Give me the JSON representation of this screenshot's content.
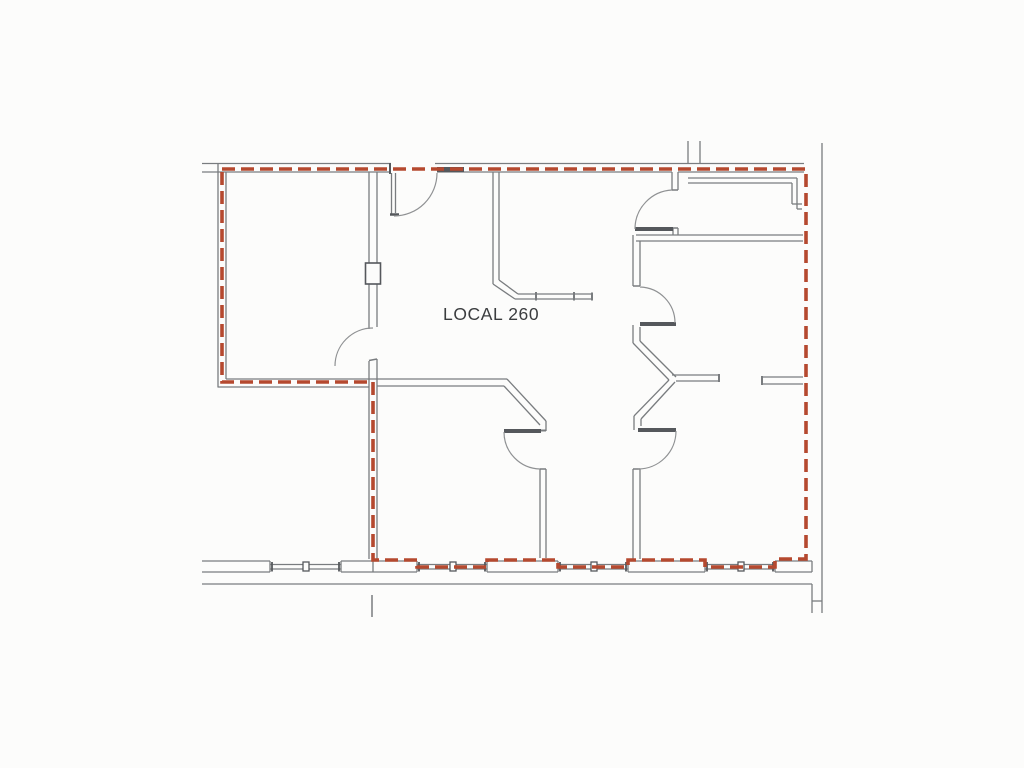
{
  "page": {
    "background": "#fcfcfb"
  },
  "plan": {
    "label": {
      "text": "LOCAL 260"
    },
    "colors": {
      "wall": "#797c7f",
      "wall_dark": "#55585c",
      "arc": "#8f9193",
      "lease": "#b5492f",
      "text": "#3b3d3f"
    },
    "lease_line": {
      "width": 3.6,
      "dash": [
        13,
        6
      ],
      "closed": true,
      "points": [
        [
          222,
          169
        ],
        [
          806,
          169
        ],
        [
          806,
          559
        ],
        [
          775,
          559
        ],
        [
          775,
          567
        ],
        [
          705,
          567
        ],
        [
          705,
          560
        ],
        [
          628,
          560
        ],
        [
          628,
          567
        ],
        [
          558,
          567
        ],
        [
          558,
          560
        ],
        [
          487,
          560
        ],
        [
          487,
          567
        ],
        [
          417,
          567
        ],
        [
          417,
          560
        ],
        [
          373,
          560
        ],
        [
          373,
          382
        ],
        [
          222,
          382
        ]
      ]
    },
    "segments": [
      [
        202,
        163.5,
        391,
        163.5
      ],
      [
        435,
        163.5,
        804,
        163.5
      ],
      [
        202,
        172,
        391,
        172
      ],
      [
        437,
        172,
        672,
        172
      ],
      [
        678,
        172,
        804,
        172
      ],
      [
        437,
        169.5,
        464,
        169.5,
        5,
        "d"
      ],
      [
        390,
        163,
        390,
        174,
        2,
        "d"
      ],
      [
        391.5,
        173,
        391.5,
        215
      ],
      [
        395.5,
        173,
        395.5,
        213
      ],
      [
        390,
        214.5,
        399,
        214.5,
        2.5,
        "d"
      ],
      [
        218,
        163,
        218,
        387.5
      ],
      [
        226,
        172,
        226,
        379
      ],
      [
        226,
        379,
        377,
        379
      ],
      [
        218,
        387,
        369,
        387
      ],
      [
        369,
        172,
        369,
        329
      ],
      [
        377,
        172,
        377,
        327
      ],
      [
        369,
        361,
        369,
        387
      ],
      [
        377,
        359,
        377,
        379
      ],
      [
        369,
        360.5,
        377,
        359,
        1.5
      ],
      [
        369,
        387,
        369,
        559
      ],
      [
        377,
        379,
        377,
        559
      ],
      [
        493,
        172,
        493,
        284
      ],
      [
        499,
        172,
        499,
        280
      ],
      [
        493,
        284,
        515,
        299
      ],
      [
        499,
        280,
        518,
        294
      ],
      [
        515,
        299,
        592,
        299
      ],
      [
        518,
        294,
        592,
        294
      ],
      [
        592,
        292.5,
        592,
        300.5,
        2
      ],
      [
        536,
        292,
        536,
        300.5,
        2
      ],
      [
        574,
        292,
        574,
        300.5,
        2
      ],
      [
        688,
        141,
        688,
        164
      ],
      [
        700,
        141,
        700,
        164
      ],
      [
        688,
        178,
        797,
        178
      ],
      [
        688,
        183,
        792,
        183
      ],
      [
        797,
        178,
        797,
        209
      ],
      [
        792,
        183,
        792,
        204
      ],
      [
        792,
        204,
        802,
        204
      ],
      [
        797,
        209,
        802,
        209
      ],
      [
        672,
        172,
        672,
        190
      ],
      [
        678,
        172,
        678,
        190
      ],
      [
        672,
        190,
        678,
        190,
        1.5
      ],
      [
        673,
        228,
        673,
        235
      ],
      [
        678,
        228,
        678,
        235
      ],
      [
        673,
        228,
        678,
        228,
        1.5
      ],
      [
        635,
        229,
        673,
        229,
        4,
        "d"
      ],
      [
        636,
        235,
        803,
        235
      ],
      [
        636,
        241,
        803,
        241
      ],
      [
        633,
        235,
        633,
        286
      ],
      [
        640,
        241,
        640,
        286
      ],
      [
        633,
        286,
        640,
        286,
        1.5
      ],
      [
        640,
        324,
        676,
        324,
        4,
        "d"
      ],
      [
        633,
        325,
        633,
        343
      ],
      [
        640,
        327,
        640,
        341
      ],
      [
        633,
        343,
        669,
        380
      ],
      [
        640,
        341,
        676,
        377
      ],
      [
        672,
        375,
        719,
        375
      ],
      [
        676,
        381,
        719,
        381
      ],
      [
        719,
        374,
        719,
        382,
        2
      ],
      [
        669,
        380,
        634,
        416
      ],
      [
        675,
        382,
        641,
        419
      ],
      [
        634,
        416,
        634,
        430
      ],
      [
        641,
        419,
        641,
        426
      ],
      [
        638,
        430,
        676,
        430,
        4,
        "d"
      ],
      [
        633,
        469,
        633,
        559
      ],
      [
        640,
        469,
        640,
        559
      ],
      [
        633,
        469,
        640,
        469,
        1.5
      ],
      [
        762,
        377,
        803,
        377
      ],
      [
        762,
        384,
        803,
        384
      ],
      [
        762,
        376,
        762,
        385,
        2
      ],
      [
        377,
        379,
        507,
        379
      ],
      [
        377,
        386,
        504,
        386
      ],
      [
        507,
        379,
        546,
        421
      ],
      [
        504,
        386,
        540,
        425
      ],
      [
        546,
        421,
        546,
        431
      ],
      [
        540,
        430.5,
        546,
        430.5,
        2
      ],
      [
        504,
        431,
        541,
        431,
        4,
        "d"
      ],
      [
        540,
        469,
        540,
        558
      ],
      [
        546,
        469,
        546,
        558
      ],
      [
        540,
        469,
        546,
        469,
        1.5
      ],
      [
        202,
        561,
        270,
        561
      ],
      [
        341,
        561,
        417,
        561
      ],
      [
        487,
        561,
        558,
        561
      ],
      [
        628,
        561,
        705,
        561
      ],
      [
        775,
        561,
        812,
        561
      ],
      [
        270,
        561,
        270,
        572
      ],
      [
        341,
        561,
        341,
        572
      ],
      [
        417,
        561,
        417,
        572
      ],
      [
        487,
        561,
        487,
        572
      ],
      [
        558,
        561,
        558,
        572
      ],
      [
        628,
        561,
        628,
        572
      ],
      [
        705,
        561,
        705,
        572
      ],
      [
        775,
        561,
        775,
        572
      ],
      [
        812,
        561,
        812,
        572
      ],
      [
        202,
        572,
        270,
        572
      ],
      [
        341,
        572,
        417,
        572
      ],
      [
        487,
        572,
        558,
        572
      ],
      [
        628,
        572,
        705,
        572
      ],
      [
        775,
        572,
        812,
        572
      ],
      [
        373,
        561,
        373,
        572
      ],
      [
        270,
        564.5,
        341,
        564.5
      ],
      [
        270,
        569,
        341,
        569
      ],
      [
        417,
        564.5,
        487,
        564.5
      ],
      [
        417,
        569,
        487,
        569
      ],
      [
        558,
        564.5,
        628,
        564.5
      ],
      [
        558,
        569,
        628,
        569
      ],
      [
        705,
        564.5,
        775,
        564.5
      ],
      [
        705,
        569,
        775,
        569
      ],
      [
        272,
        562,
        272,
        571.5,
        1.8,
        "d"
      ],
      [
        339,
        562,
        339,
        571.5,
        1.8,
        "d"
      ],
      [
        419,
        562,
        419,
        571.5,
        1.8,
        "d"
      ],
      [
        485,
        562,
        485,
        571.5,
        1.8,
        "d"
      ],
      [
        560,
        562,
        560,
        571.5,
        1.8,
        "d"
      ],
      [
        626,
        562,
        626,
        571.5,
        1.8,
        "d"
      ],
      [
        707,
        562,
        707,
        571.5,
        1.8,
        "d"
      ],
      [
        773,
        562,
        773,
        571.5,
        1.8,
        "d"
      ],
      [
        202,
        584,
        812,
        584
      ],
      [
        372,
        595,
        372,
        617,
        1.5
      ],
      [
        822,
        143,
        822,
        613
      ],
      [
        812,
        584,
        812,
        613
      ],
      [
        812,
        601,
        822,
        601
      ]
    ],
    "door_arcs": [
      {
        "sx": 394,
        "sy": 216,
        "ex": 437,
        "ey": 173,
        "r": 43,
        "sweep": 0
      },
      {
        "sx": 335,
        "sy": 366,
        "ex": 373,
        "ey": 328,
        "r": 38,
        "sweep": 1
      },
      {
        "sx": 635,
        "sy": 229,
        "ex": 672,
        "ey": 190,
        "r": 39,
        "sweep": 1
      },
      {
        "sx": 640,
        "sy": 287,
        "ex": 675,
        "ey": 323,
        "r": 36,
        "sweep": 1
      },
      {
        "sx": 676,
        "sy": 431,
        "ex": 638,
        "ey": 469,
        "r": 38,
        "sweep": 1
      },
      {
        "sx": 504,
        "sy": 432,
        "ex": 540,
        "ey": 469,
        "r": 37,
        "sweep": 0
      }
    ],
    "rects": [
      {
        "x": 365.5,
        "y": 263,
        "w": 15,
        "h": 21,
        "sw": 1.6,
        "c": "d"
      },
      {
        "x": 303,
        "y": 562,
        "w": 6,
        "h": 9,
        "sw": 1.3,
        "c": "d"
      },
      {
        "x": 450,
        "y": 562,
        "w": 6,
        "h": 9,
        "sw": 1.3,
        "c": "d"
      },
      {
        "x": 591,
        "y": 562,
        "w": 6,
        "h": 9,
        "sw": 1.3,
        "c": "d"
      },
      {
        "x": 738,
        "y": 562,
        "w": 6,
        "h": 9,
        "sw": 1.3,
        "c": "d"
      }
    ],
    "label_pos": {
      "x": 443,
      "y": 320
    }
  }
}
